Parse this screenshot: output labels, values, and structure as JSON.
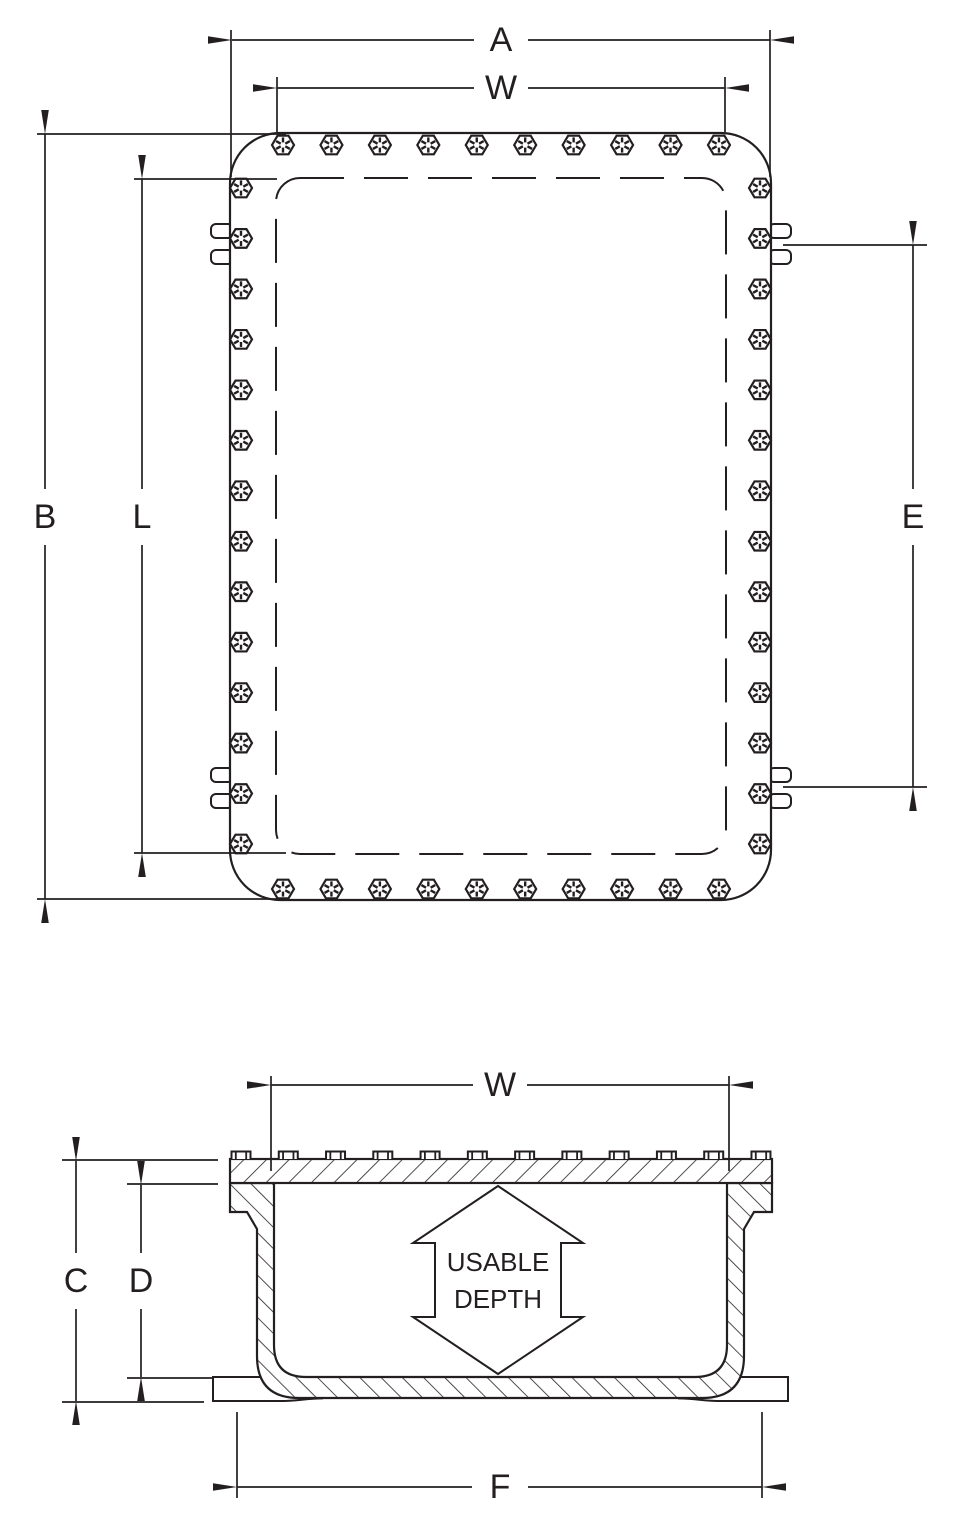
{
  "page": {
    "background_color": "#ffffff",
    "line_color": "#231f20"
  },
  "drawing": {
    "type": "enclosure dimension drawing",
    "labels": {
      "a": "A",
      "w_plan": "W",
      "b": "B",
      "l": "L",
      "e": "E",
      "w_section": "W",
      "c": "C",
      "d": "D",
      "f": "F",
      "usable_depth_line1": "USABLE",
      "usable_depth_line2": "DEPTH"
    },
    "top_view": {
      "description": "Plan view of bolted enclosure cover with mounting lugs",
      "bolt_counts": {
        "top_row": 10,
        "bottom_row": 10,
        "left_column": 14,
        "right_column": 14
      },
      "lug_pair_count": 4
    },
    "section_view": {
      "description": "Cross section of enclosure body and cover",
      "cover_bolt_count": 12
    }
  }
}
